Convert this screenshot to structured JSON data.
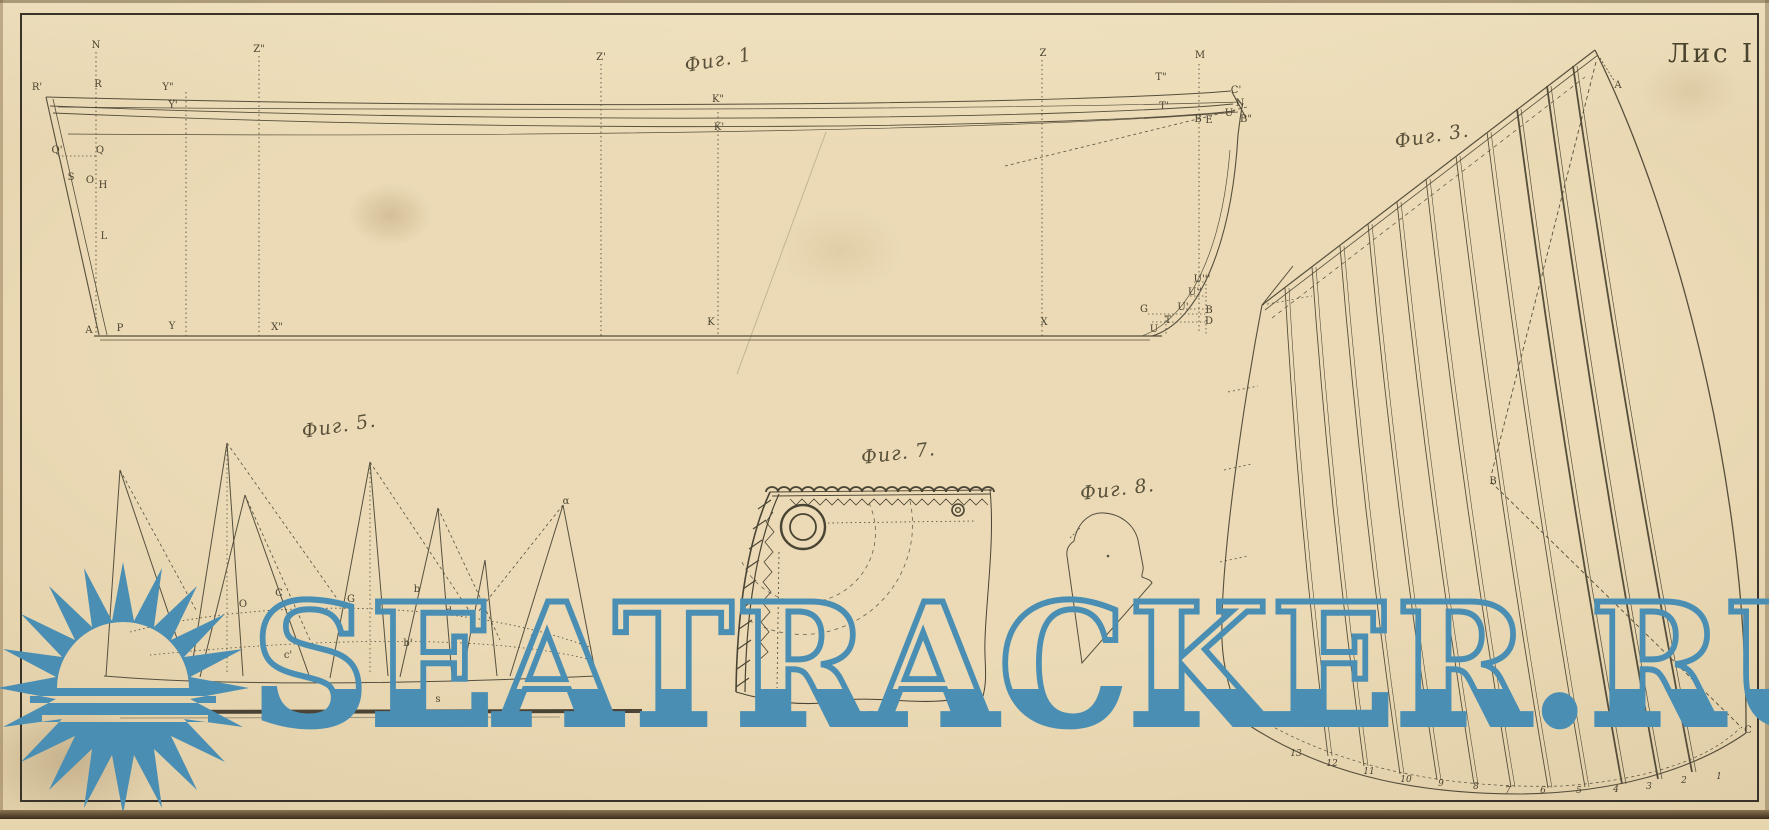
{
  "sheet": {
    "label": "Лис I"
  },
  "watermark": {
    "text": "SEATRACKER.RU",
    "color": "#4a8fb3",
    "logo_icon": "sun-over-sea"
  },
  "figures": {
    "fig1": {
      "caption": "Фиг. 1",
      "points": {
        "N": "N",
        "R1": "R'",
        "R": "R",
        "Y2": "Y\"",
        "Y1": "Y'",
        "Q1": "Q'",
        "Q": "Q",
        "S": "S",
        "O": "O",
        "H": "H",
        "L": "L",
        "A": "A",
        "P": "P",
        "Y": "Y",
        "Z2": "Z\"",
        "Z1": "Z'",
        "K2": "K\"",
        "K1": "K'",
        "Z": "Z",
        "M": "M",
        "T2": "T\"",
        "T1": "T'",
        "C1": "C'",
        "N1": "N",
        "U": "U",
        "B2": "B\"",
        "B": "B",
        "E": "E",
        "X2": "X\"",
        "K": "K",
        "X": "X",
        "G": "G",
        "U3": "U'''",
        "U2": "U''",
        "U1": "U'",
        "T": "T",
        "Ub": "U",
        "B1": "B",
        "D": "D"
      }
    },
    "fig3": {
      "caption": "Фиг. 3.",
      "points": {
        "A": "A",
        "B": "B",
        "C": "C"
      },
      "foot_numbers": [
        "13",
        "12",
        "11",
        "10",
        "9",
        "8",
        "7",
        "6",
        "5",
        "4",
        "3",
        "2",
        "1"
      ]
    },
    "fig5": {
      "caption": "Фиг. 5.",
      "points": {
        "C": "C",
        "O": "O",
        "G": "G",
        "b": "b",
        "d": "d",
        "b1": "b'",
        "a": "a",
        "c1": "c'",
        "alpha": "α",
        "s": "s"
      }
    },
    "fig7": {
      "caption": "Фиг. 7."
    },
    "fig8": {
      "caption": "Фиг. 8."
    }
  }
}
